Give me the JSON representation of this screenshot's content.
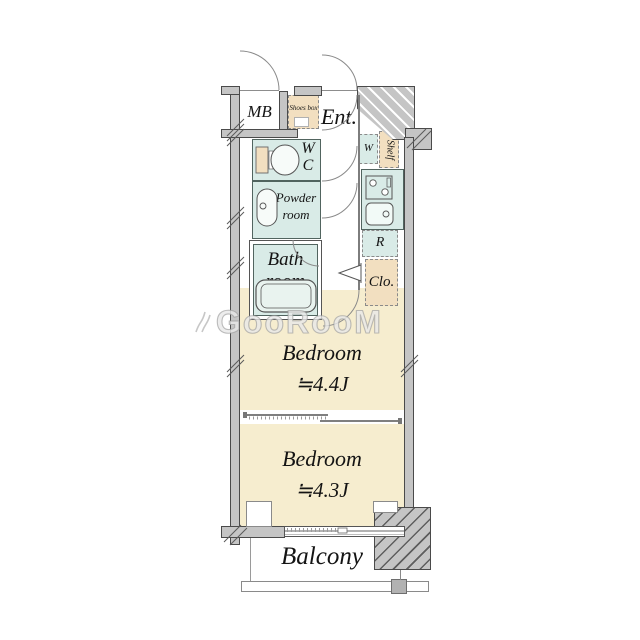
{
  "watermark": {
    "text": "GooRooM"
  },
  "rooms": {
    "mb": "MB",
    "shoes_box": "Shoes box",
    "entrance": "Ent.",
    "wc_line1": "W",
    "wc_line2": "C",
    "powder_line1": "Powder",
    "powder_line2": "room",
    "bath_line1": "Bath",
    "bath_line2": "room",
    "washer": "W",
    "shelf": "Shelf",
    "fridge": "R",
    "closet": "Clo.",
    "bedroom1_name": "Bedroom",
    "bedroom1_size": "≒4.4J",
    "bedroom2_name": "Bedroom",
    "bedroom2_size": "≒4.3J",
    "balcony": "Balcony"
  },
  "colors": {
    "wall": "#c5c5c5",
    "wet_room": "#d9ebe7",
    "storage_beige": "#f2dfc0",
    "bedroom_floor": "#f6edcf"
  }
}
